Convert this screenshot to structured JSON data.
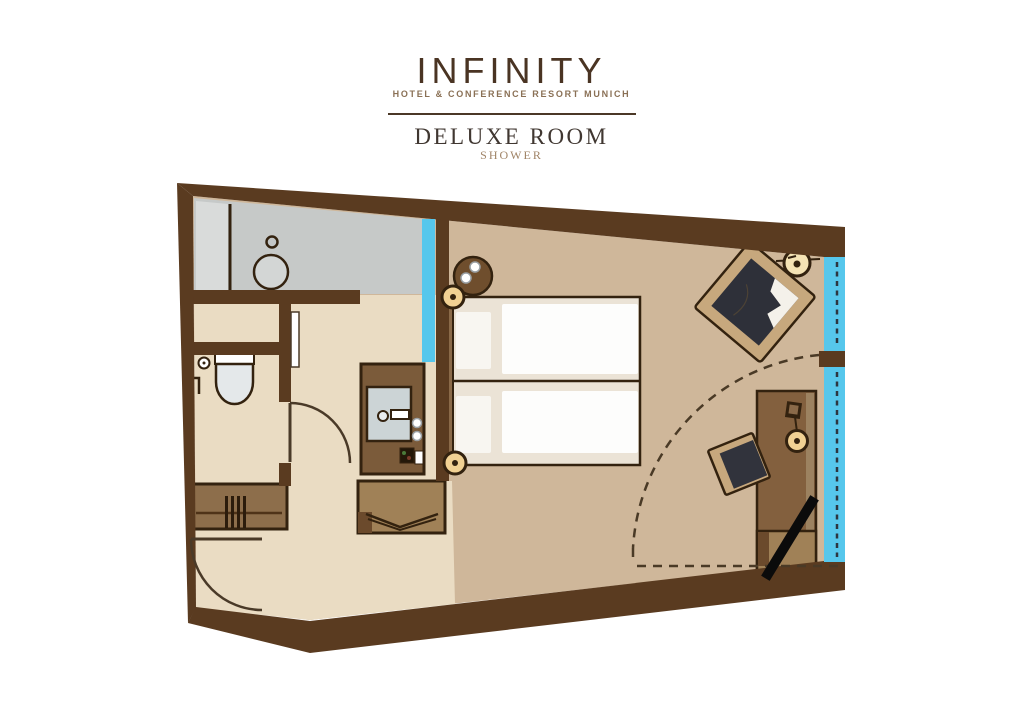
{
  "header": {
    "brand": "INFINITY",
    "tagline": "HOTEL & CONFERENCE RESORT MUNICH",
    "room_title": "DELUXE ROOM",
    "room_subtitle": "SHOWER"
  },
  "palette": {
    "wall_brown": "#5a3b20",
    "floor_main": "#cfb79a",
    "floor_entry": "#eadcc3",
    "floor_shower": "#c6c9c8",
    "floor_shower_light": "#d9dbda",
    "window_glass": "#56c7ec",
    "furniture_brown": "#83603e",
    "furniture_light": "#a08157",
    "lamp_gold": "#f1d193",
    "seat_charcoal": "#2e3039",
    "linen_white": "#fdfdfc",
    "outline_dark": "#33220f",
    "logo_brown": "#4a3423",
    "tagline_taupe": "#8a7055"
  },
  "floorplan": {
    "elements": [
      "outer-walls",
      "shower-area",
      "shower-glass-panel",
      "shower-drain",
      "toilet",
      "toilet-paper-holder",
      "grab-bar",
      "wc-door",
      "sliding-door",
      "washbasin-vanity",
      "coffee-machine",
      "water-glasses",
      "luggage-rack",
      "wardrobe",
      "entrance-door",
      "double-bed",
      "pillows",
      "duvets",
      "headboard",
      "bedside-table",
      "bedside-lamp-top",
      "bedside-lamp-bottom",
      "armchair",
      "floor-lamp",
      "desk",
      "desk-chair",
      "desk-lamp",
      "telephone",
      "tv-wall-mount",
      "window-upper",
      "window-lower",
      "curtain-swing-arc"
    ]
  }
}
